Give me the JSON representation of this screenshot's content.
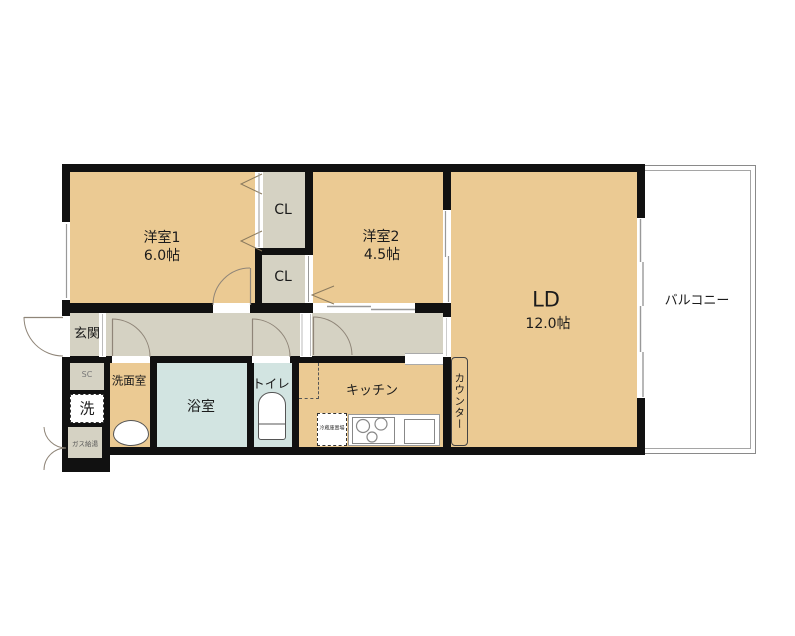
{
  "plan": {
    "type": "apartment-floor-plan",
    "colors": {
      "room_tan": "#EBCA93",
      "hall_gray": "#D5D2C3",
      "wet_blue": "#D2E4E1",
      "wall_black": "#111111",
      "balcony_line": "#8A8A8A",
      "arc_stroke": "#8F8578"
    },
    "rooms": {
      "yoshitsu1": {
        "name": "洋室1",
        "size": "6.0帖"
      },
      "yoshitsu2": {
        "name": "洋室2",
        "size": "4.5帖"
      },
      "ld": {
        "name": "LD",
        "size": "12.0帖"
      },
      "cl_top": {
        "name": "CL"
      },
      "cl_bottom": {
        "name": "CL"
      },
      "balcony": {
        "name": "バルコニー"
      },
      "genkan": {
        "name": "玄関"
      },
      "washroom": {
        "name": "洗面室"
      },
      "bathroom": {
        "name": "浴室"
      },
      "toilet": {
        "name": "トイレ"
      },
      "kitchen": {
        "name": "キッチン"
      },
      "counter": {
        "name": "カウンター"
      }
    },
    "fixtures": {
      "shoe_closet": {
        "name": "SC"
      },
      "laundry": {
        "name": "洗"
      },
      "gas_heater": {
        "name": "ガス給湯"
      },
      "fridge_space": {
        "name": "冷蔵庫置場"
      }
    }
  }
}
